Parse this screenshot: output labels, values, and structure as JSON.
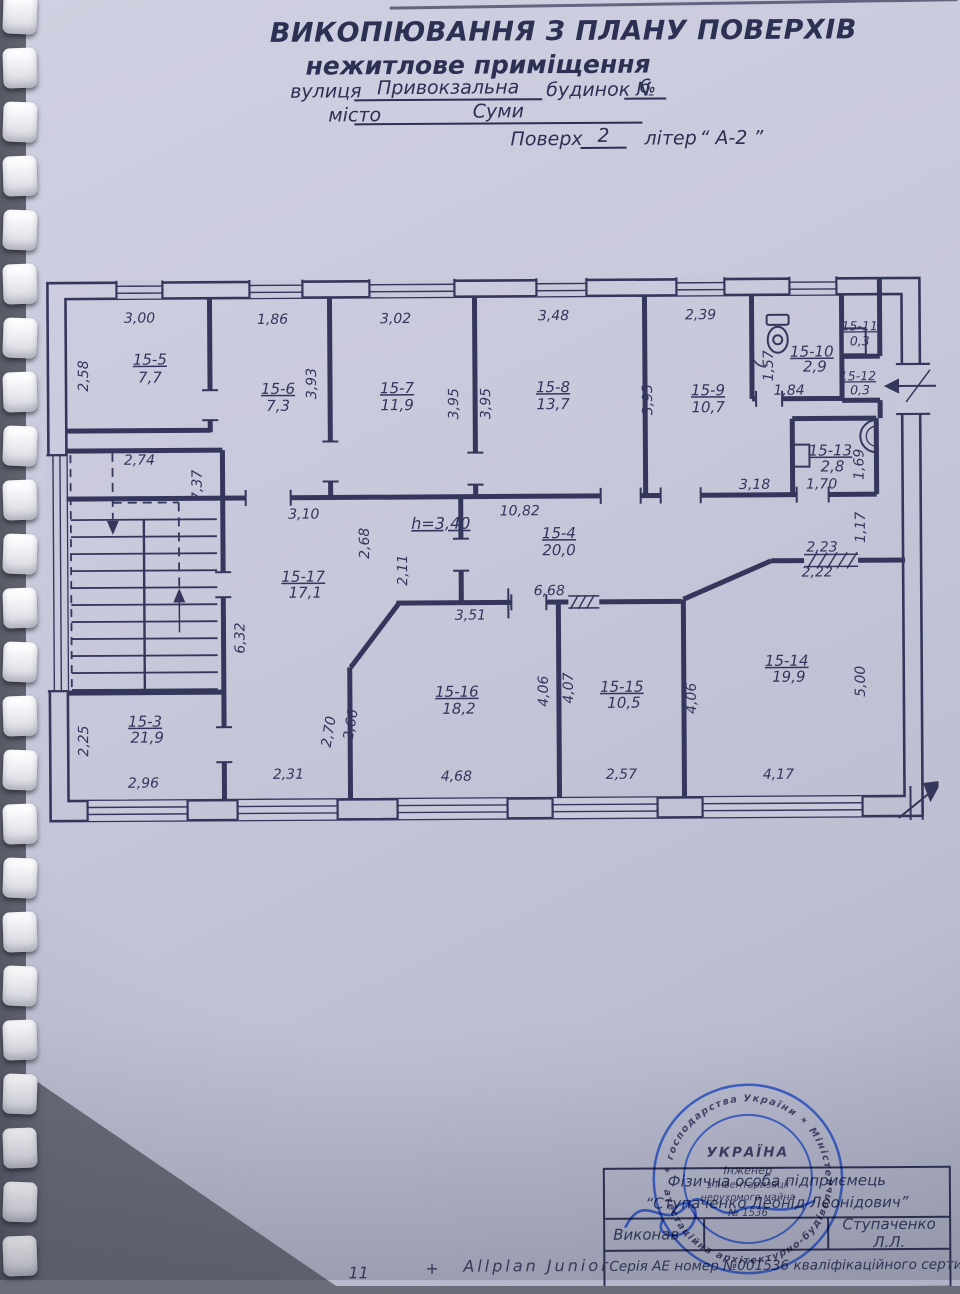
{
  "header": {
    "title": "ВИКОПІЮВАННЯ З ПЛАНУ ПОВЕРХІВ",
    "subtitle": "нежитлове приміщення",
    "street_label": "вулиця",
    "street_value": "Привокзальна",
    "building_label": "будинок №",
    "building_value": "6",
    "city_label": "місто",
    "city_value": "Суми",
    "floor_label": "Поверх",
    "floor_value": "2",
    "liter_label": "літер",
    "liter_value": "“ А-2 ”"
  },
  "plan": {
    "height_note": "h=3,40",
    "rooms": {
      "r3": {
        "id": "15-3",
        "area": "21,9"
      },
      "r4": {
        "id": "15-4",
        "area": "20,0"
      },
      "r5": {
        "id": "15-5",
        "area": "7,7"
      },
      "r6": {
        "id": "15-6",
        "area": "7,3"
      },
      "r7": {
        "id": "15-7",
        "area": "11,9"
      },
      "r8": {
        "id": "15-8",
        "area": "13,7"
      },
      "r9": {
        "id": "15-9",
        "area": "10,7"
      },
      "r10": {
        "id": "15-10",
        "area": "2,9"
      },
      "r11": {
        "id": "15-11",
        "area": "0,3"
      },
      "r12": {
        "id": "15-12",
        "area": "0,3"
      },
      "r13": {
        "id": "15-13",
        "area": "2,8"
      },
      "r14": {
        "id": "15-14",
        "area": "19,9"
      },
      "r15": {
        "id": "15-15",
        "area": "10,5"
      },
      "r16": {
        "id": "15-16",
        "area": "18,2"
      },
      "r17": {
        "id": "15-17",
        "area": "17,1"
      }
    },
    "dims": {
      "r5_top": "3,00",
      "r5_left": "2,58",
      "r6_top": "1,86",
      "r6_right": "3,93",
      "r7_top": "3,02",
      "r7_right": "3,95",
      "r8_top": "3,48",
      "r8_left": "3,95",
      "r8_right": "3,93",
      "r9_top": "2,39",
      "r9_bottom": "3,18",
      "r10_left": "1,57",
      "r10_bottom": "1,84",
      "r13_bottom": "1,70",
      "r13_right": "1,69",
      "stair_top": "2,74",
      "stair_right": "7,37",
      "r17_top": "3,10",
      "r17_seg1": "2,68",
      "r17_seg2": "2,11",
      "r17_left": "6,32",
      "r17_bottom": "2,31",
      "r17_diag": "2,70",
      "r4_top": "10,82",
      "r4_bottom": "6,68",
      "r16_top": "3,51",
      "r16_diag": "2,66",
      "r16_right": "4,06",
      "r16_bottom": "4,68",
      "r15_left": "4,07",
      "r15_bottom": "2,57",
      "r14_left": "4,06",
      "r14_top1": "2,23",
      "r14_top2": "2,22",
      "r14_right1": "1,17",
      "r14_right2": "5,00",
      "r14_bottom": "4,17",
      "r3_left": "2,25",
      "r3_bottom": "2,96"
    }
  },
  "stamp": {
    "line1": "Фізична особа підприємець",
    "line2": "“Ступаченко Леонід Леонідович”",
    "executor_label": "Виконав",
    "executor_name": "Ступаченко Л.Л.",
    "serial": "Серія АЕ номер №001536 кваліфікаційного сертифікату."
  },
  "seal": {
    "ring_top": "✶ господарства України ✶ Міністерство регіонального ✶",
    "ring_bottom": "атестаційна архітектурно-будівельна комісія",
    "center": [
      "УКРАЇНА",
      "Інженер",
      "з інвентаризації",
      "нерухомого майна",
      "№ 1536"
    ]
  },
  "footer": {
    "n": "11",
    "plus": "+",
    "software": "Allplan Junior"
  }
}
